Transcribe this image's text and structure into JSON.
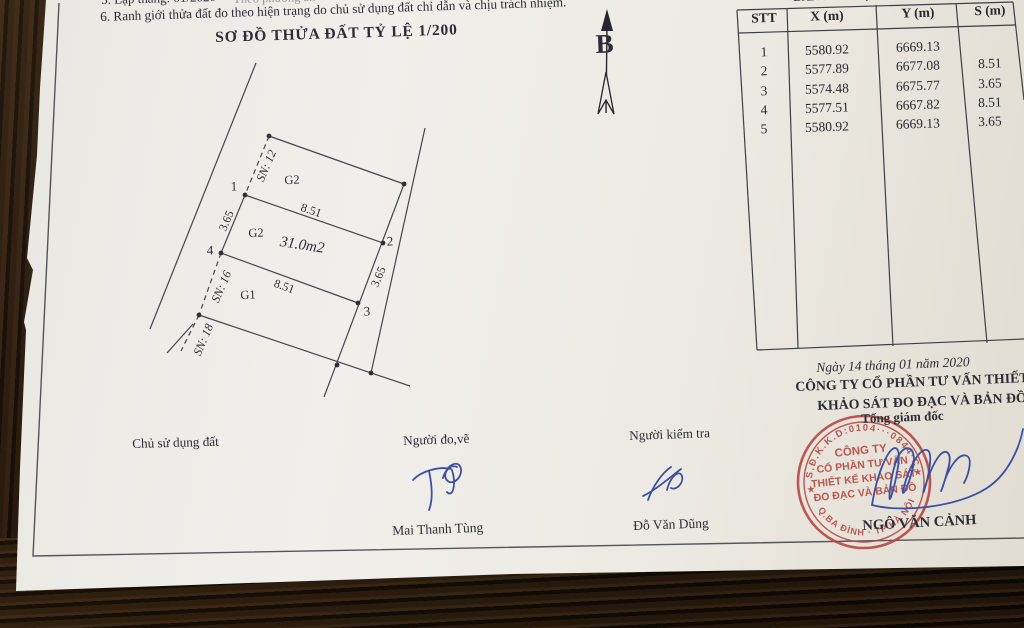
{
  "notes": {
    "line5": "5. Lập tháng:  01/2020",
    "line5_cont": "Theo phương án",
    "line6": "6. Ranh giới thửa đất đo theo hiện trạng do chủ sử dụng đất chỉ dẫn và chịu trách nhiệm.",
    "title": "SƠ ĐỒ THỬA ĐẤT TỶ LỆ 1/200"
  },
  "table": {
    "caption_partial": "BẢNG KÊ TỌA ĐỘ",
    "headers": [
      "STT",
      "X (m)",
      "Y (m)",
      "S (m)"
    ],
    "rows": [
      {
        "stt": "1",
        "x": "5580.92",
        "y": "6669.13",
        "s": ""
      },
      {
        "stt": "2",
        "x": "5577.89",
        "y": "6677.08",
        "s": "8.51"
      },
      {
        "stt": "3",
        "x": "5574.48",
        "y": "6675.77",
        "s": "3.65"
      },
      {
        "stt": "4",
        "x": "5577.51",
        "y": "6667.82",
        "s": "8.51"
      },
      {
        "stt": "5",
        "x": "5580.92",
        "y": "6669.13",
        "s": "3.65"
      }
    ]
  },
  "diagram": {
    "compass_label": "B",
    "area_label": "31.0m2",
    "corner_labels": [
      "1",
      "2",
      "3",
      "4"
    ],
    "side_labels": {
      "top": "8.51",
      "bottom": "8.51",
      "left": "3.65",
      "right": "3.65"
    },
    "neighbor_labels": [
      "G2",
      "G2",
      "G1"
    ],
    "frontage_labels": [
      "SN: 12",
      "SN: 16",
      "SN: 18"
    ]
  },
  "footer": {
    "date_line": "Ngày  14  tháng  01  năm 2020",
    "company_line1": "CÔNG TY CỔ PHẦN TƯ VẤN THIẾT KẾ",
    "company_line2": "KHẢO SÁT ĐO ĐẠC VÀ BẢN ĐỒ"
  },
  "signatures": {
    "roles": [
      "Chủ sử dụng đất",
      "Người đo,vẽ",
      "Người kiểm tra"
    ],
    "names": [
      "Mai Thanh Tùng",
      "Đỗ Văn Dũng"
    ],
    "director_title": "Tổng giám đốc",
    "director_name": "NGÔ VĂN CẢNH"
  },
  "stamp": {
    "arc_top": "S.Đ.K.K.D:0104···0844·C",
    "arc_bottom": "Q.BA ĐÌNH · TP HÀ NỘI",
    "star": "★",
    "center_lines": [
      "CÔNG TY",
      "CỔ PHẦN TƯ VẤN",
      "THIẾT KẾ KHẢO SÁT",
      "ĐO ĐẠC VÀ BẢN ĐỒ"
    ]
  },
  "colors": {
    "stamp_red": "#b5433e",
    "signature_blue": "#3c50a2",
    "ink": "#2c2c34"
  }
}
